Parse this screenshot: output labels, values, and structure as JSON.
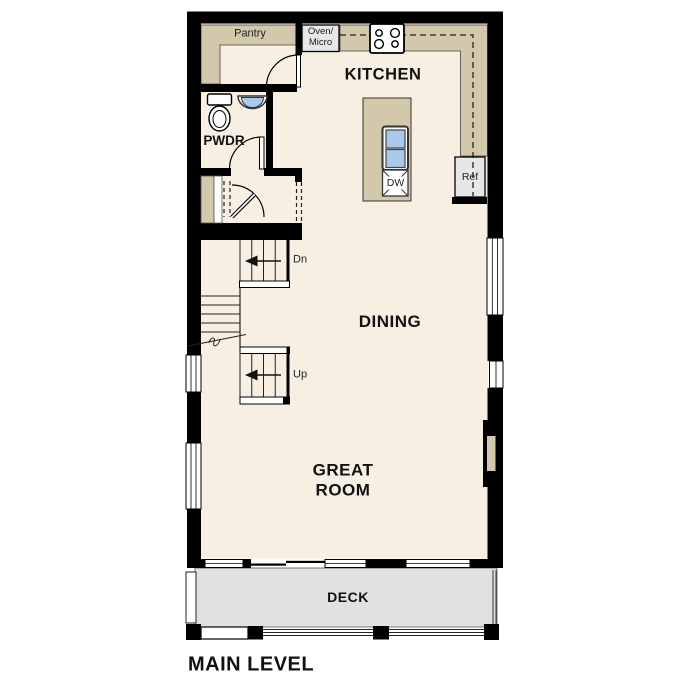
{
  "title": {
    "text": "MAIN LEVEL"
  },
  "rooms": {
    "kitchen": "KITCHEN",
    "dining": "DINING",
    "great_room": "GREAT ROOM",
    "deck": "DECK",
    "powder": "PWDR",
    "pantry": "Pantry"
  },
  "appliances": {
    "oven_micro_line1": "Oven/",
    "oven_micro_line2": "Micro",
    "refrigerator": "Ref",
    "dishwasher": "DW"
  },
  "stairs": {
    "down": "Dn",
    "up": "Up"
  },
  "colors": {
    "wall": "#000000",
    "floor": "#f6efe2",
    "counter": "#d3c7ac",
    "deck": "#e1e1e1",
    "appliance": "#e7e7e7",
    "fixture_blue": "#aac8ea",
    "outline": "#222222"
  }
}
